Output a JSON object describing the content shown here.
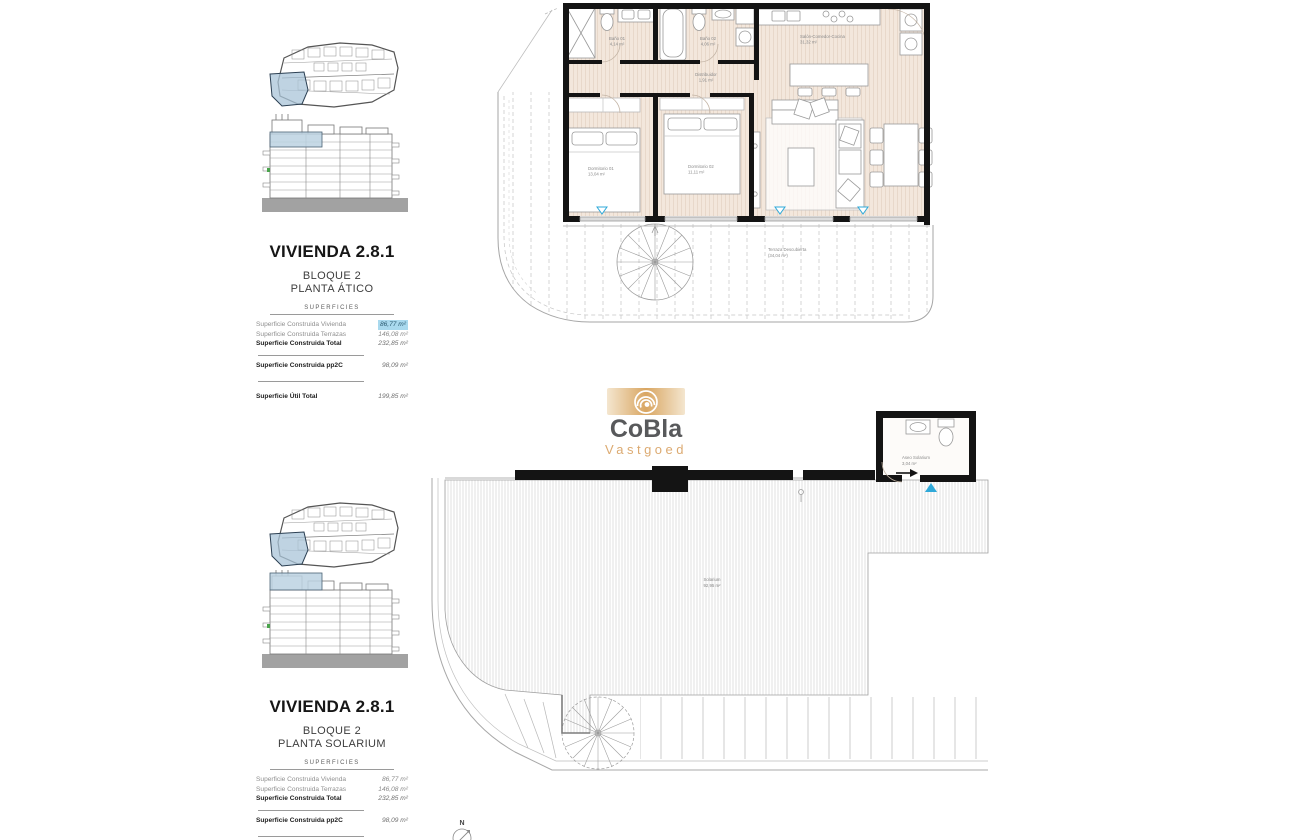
{
  "brand": {
    "name": "CoBla",
    "subtitle": "Vastgoed",
    "tan": "#dcaa71",
    "gray": "#58595b"
  },
  "panel_atico": {
    "title": "VIVIENDA 2.8.1",
    "block": "BLOQUE 2",
    "floor": "PLANTA ÁTICO",
    "header": "SUPERFICIES",
    "rows": [
      {
        "label": "Superficie Construida Vivienda",
        "value": "86,77 m²"
      },
      {
        "label": "Superficie Construida Terrazas",
        "value": "146,08 m²"
      },
      {
        "label": "Superficie Construida Total",
        "value": "232,85 m²"
      },
      {
        "label": "Superficie Construida pp2C",
        "value": "98,09 m²"
      },
      {
        "label": "Superficie Útil Total",
        "value": "199,85 m²"
      }
    ],
    "highlight_color": "#a9d9ee"
  },
  "panel_solarium": {
    "title": "VIVIENDA 2.8.1",
    "block": "BLOQUE 2",
    "floor": "PLANTA SOLARIUM",
    "header": "SUPERFICIES",
    "rows": [
      {
        "label": "Superficie Construida Vivienda",
        "value": "86,77 m²"
      },
      {
        "label": "Superficie Construida Terrazas",
        "value": "146,08 m²"
      },
      {
        "label": "Superficie Construida Total",
        "value": "232,85 m²"
      },
      {
        "label": "Superficie Construida pp2C",
        "value": "98,09 m²"
      },
      {
        "label": "Superficie Útil Total",
        "value": "199,85 m²"
      }
    ]
  },
  "plan_atico": {
    "rooms": {
      "bano1": {
        "name": "Baño 01",
        "area": "4,14 m²"
      },
      "bano2": {
        "name": "Baño 02",
        "area": "4,06 m²"
      },
      "distribuidor": {
        "name": "Distribuidor",
        "area": "1,91 m²"
      },
      "salon": {
        "name": "Salón-Comedor-Cocina",
        "area": "31,32 m²"
      },
      "dorm1": {
        "name": "Dormitorio 01",
        "area": "13,04 m²"
      },
      "dorm2": {
        "name": "Dormitorio 02",
        "area": "11,11 m²"
      },
      "terraza": {
        "name": "Terraza Descubierta",
        "area": "(34,04 m²)"
      }
    }
  },
  "plan_solarium": {
    "rooms": {
      "solarium": {
        "name": "Solarium",
        "area": "92,95 m²"
      },
      "aseo": {
        "name": "Aseo Solarium",
        "area": "3,04 m²"
      }
    },
    "north_label": "N"
  },
  "colors": {
    "floor": "#f3e7dc",
    "wall": "#141414",
    "marker_blue": "#2fa9d9"
  }
}
